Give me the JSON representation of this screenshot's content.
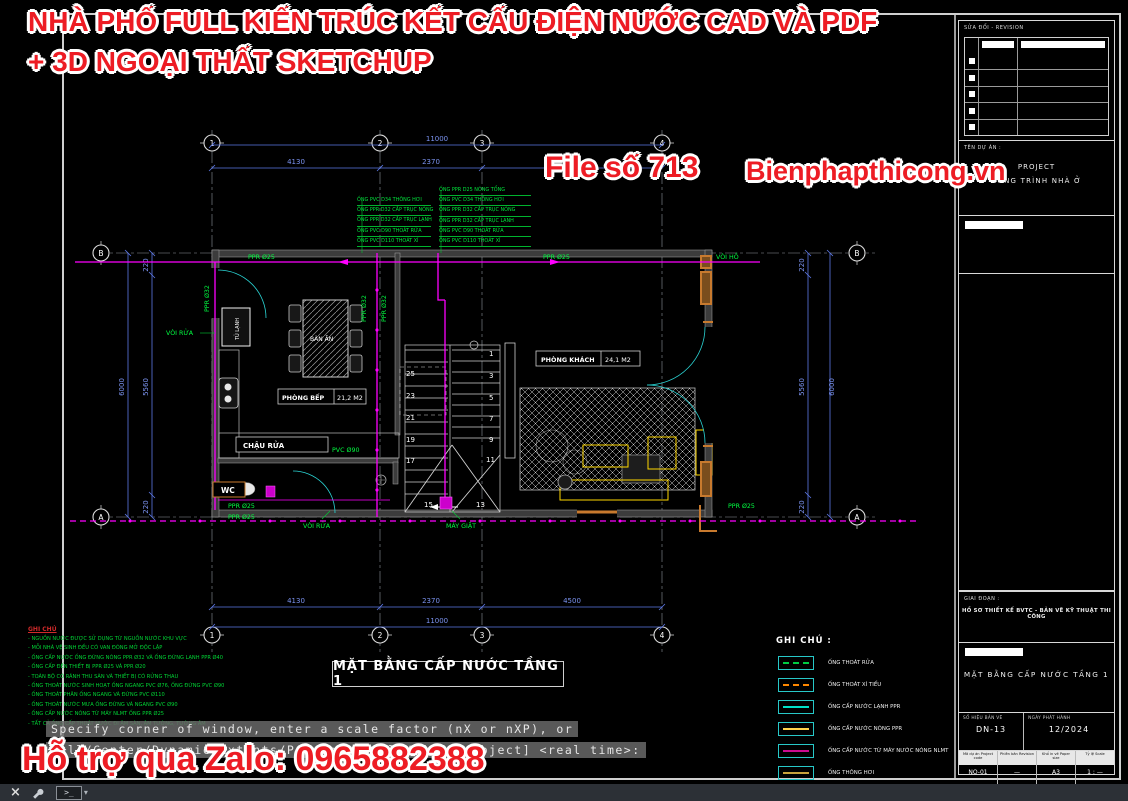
{
  "watermarks": {
    "headline1": "NHÀ PHỐ FULL KIẾN TRÚC KẾT CẤU ĐIỆN NƯỚC CAD VÀ PDF",
    "headline2": "+ 3D NGOẠI THẤT SKETCHUP",
    "file_number": "File số 713",
    "website": "Bienphapthicong.vn",
    "zalo_support": "Hỗ trợ qua Zalo: 0965882388",
    "color": "#ed1c24"
  },
  "plan": {
    "title": "MẶT BẰNG CẤP NƯỚC TẦNG 1",
    "grid_cols": [
      "1",
      "2",
      "3",
      "4"
    ],
    "grid_row_top": "B",
    "grid_row_bottom": "A",
    "dims": {
      "overall_width": "11000",
      "width_segments": [
        "4130",
        "2370",
        "4500"
      ],
      "overall_height": "6000",
      "height_inner": "5560",
      "height_edge": "220"
    },
    "rooms": {
      "kitchen_name": "PHÒNG BẾP",
      "kitchen_area": "21,2 M2",
      "living_name": "PHÒNG KHÁCH",
      "living_area": "24,1 M2"
    },
    "fixtures": {
      "dining_table": "BÀN ĂN",
      "fridge": "TỦ LẠNH",
      "sink": "CHẬU RỬA",
      "wc": "WC",
      "faucet_left": "VÒI RỬA",
      "faucet_bottom": "VÒI RỬA",
      "washing_machine": "MÁY GIẶT",
      "garden_tap": "VÒI HỒ"
    },
    "pipe_labels": {
      "ppr25": "PPR Ø25",
      "ppr32": "PPR Ø32",
      "pvc90": "PVC Ø90"
    },
    "stair_numbers": {
      "left": [
        "25",
        "23",
        "21",
        "19",
        "17"
      ],
      "right": [
        "1",
        "3",
        "5",
        "7",
        "9",
        "11"
      ],
      "bottom": [
        "15",
        "13"
      ]
    },
    "riser_list_left": [
      "ỐNG PVC D34 THÔNG HƠI",
      "ỐNG PPR D32 CẤP TRỤC NÓNG",
      "ỐNG PPR D32 CẤP TRỤC LẠNH",
      "ỐNG PVC D90 THOÁT RỬA",
      "ỐNG PVC D110 THOÁT XÍ"
    ],
    "riser_list_right": [
      "ỐNG PPR D25 NÓNG TỔNG",
      "ỐNG PVC D34 THÔNG HƠI",
      "ỐNG PPR D32 CẤP TRỤC NÓNG",
      "ỐNG PPR D32 CẤP TRỤC LẠNH",
      "ỐNG PVC D90 THOÁT RỬA",
      "ỐNG PVC D110 THOÁT XÍ"
    ]
  },
  "legend": {
    "title": "GHI CHÚ :",
    "items": [
      {
        "label": "ỐNG THOÁT RỬA",
        "color": "#00cc44",
        "style": "dashed"
      },
      {
        "label": "ỐNG THOÁT XÍ TIỂU",
        "color": "#ff8800",
        "style": "dashed"
      },
      {
        "label": "ỐNG CẤP NƯỚC LẠNH PPR",
        "color": "#00e0c8",
        "style": "solid"
      },
      {
        "label": "ỐNG CẤP NƯỚC NÓNG PPR",
        "color": "#ffd24d",
        "style": "solid"
      },
      {
        "label": "ỐNG CẤP NƯỚC TỪ MÁY NƯỚC NÓNG NLMT",
        "color": "#cc0b8f",
        "style": "solid"
      },
      {
        "label": "ỐNG THÔNG HƠI",
        "color": "#c8a23c",
        "style": "solid"
      }
    ]
  },
  "notes": {
    "title": "GHI CHÚ",
    "lines": [
      "- NGUỒN NƯỚC ĐƯỢC SỬ DỤNG TỪ NGUỒN NƯỚC KHU VỰC",
      "- MỖI NHÀ VỆ SINH ĐỀU CÓ VAN ĐÓNG MỞ ĐỘC LẬP",
      "- ỐNG CẤP NƯỚC ỐNG ĐỨNG NÓNG PPR Ø32 VÀ ỐNG ĐỨNG LẠNH PPR Ø40",
      "- ỐNG CẤP ĐẾN THIẾT BỊ PPR Ø25 VÀ PPR Ø20",
      "- TOÀN BỘ CÓ RÃNH THU SÀN VÀ THIẾT BỊ CÓ RỬNG THAU",
      "- ỐNG THOÁT NƯỚC SINH HOẠT ỐNG NGANG PVC Ø76, ỐNG ĐỨNG PVC Ø90",
      "- ỐNG THOÁT PHÂN ỐNG NGANG VÀ ĐỨNG PVC Ø110",
      "- ỐNG THOÁT NƯỚC MƯA ỐNG ĐỨNG VÀ NGANG PVC Ø90",
      "- ỐNG CẤP NƯỚC NÓNG TỪ MÁY NLMT ỐNG PPR Ø25",
      "- TẤT CẢ ỐNG CẤP THOÁT NƯỚC ĐI ÂM SÀN, ÂM TƯỜNG, TƯỜNG ÂM"
    ]
  },
  "command_line": {
    "line1": "Specify corner of window, enter a scale factor (nX or nXP), or",
    "line2": "[All/Center/Dynamic/Extents/Previous/Scale/Window/Object] <real time>:"
  },
  "title_block": {
    "revision_header": "SỬA ĐỔI - REVISION",
    "revision_rows": [
      "",
      "",
      "",
      "",
      ""
    ],
    "project_label": "TÊN DỰ ÁN :",
    "project_name_en": "PROJECT",
    "project_name_vi": "CÔNG TRÌNH NHÀ Ở",
    "phase_label": "GIAI ĐOẠN :",
    "phase_value": "HỒ SƠ THIẾT KẾ BVTC - BẢN VẼ KỸ THUẬT THI CÔNG",
    "sheet_title": "MẶT BẰNG CẤP NƯỚC TẦNG 1",
    "sheet_no_label": "SỐ HIỆU BẢN VẼ",
    "sheet_no": "DN-13",
    "issue_date_label": "NGÀY PHÁT HÀNH",
    "issue_date": "12/2024",
    "footer": [
      {
        "label": "Mã dự án Project code",
        "value": "NO-01"
      },
      {
        "label": "Phiên bản Revision",
        "value": "—"
      },
      {
        "label": "Khổ in vẽ Paper size",
        "value": "A3"
      },
      {
        "label": "Tỷ lệ Scale",
        "value": "1 : —"
      }
    ]
  },
  "statusbar": {
    "icons": [
      "close-icon",
      "wrench-icon",
      "command-prompt-icon"
    ],
    "prompt_glyph": ">_",
    "caret": "▾"
  }
}
